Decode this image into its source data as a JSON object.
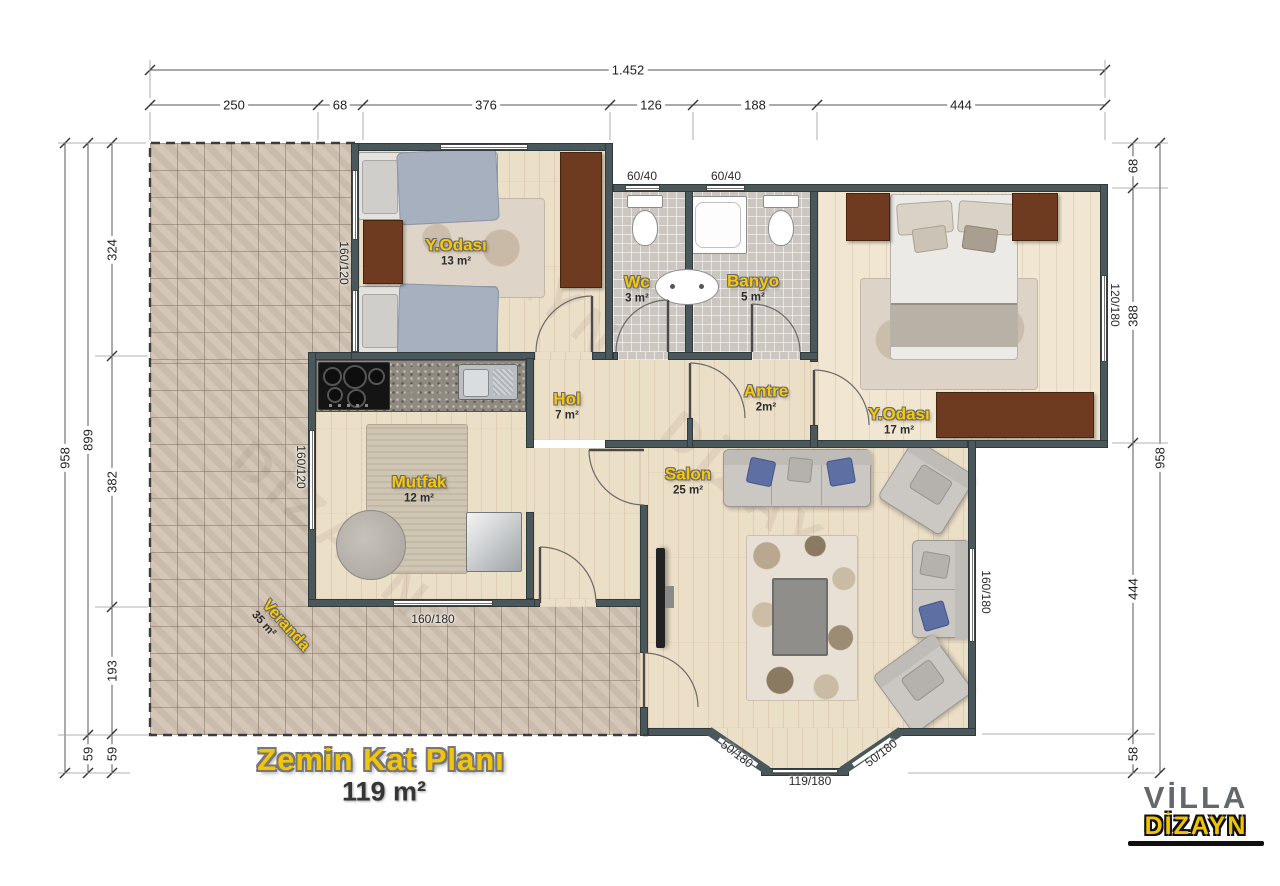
{
  "title": {
    "name": "Zemin Kat Planı",
    "area": "119 m²"
  },
  "logo": {
    "top": "VİLLA",
    "bottom": "DİZAYN"
  },
  "watermark": "DİZAYN",
  "rooms": {
    "bedroom1": {
      "name": "Y.Odası",
      "area": "13 m²"
    },
    "wc": {
      "name": "Wc",
      "area": "3 m²"
    },
    "banyo": {
      "name": "Banyo",
      "area": "5 m²"
    },
    "bedroom2": {
      "name": "Y.Odası",
      "area": "17 m²"
    },
    "hol": {
      "name": "Hol",
      "area": "7 m²"
    },
    "antre": {
      "name": "Antre",
      "area": "2m²"
    },
    "mutfak": {
      "name": "Mutfak",
      "area": "12 m²"
    },
    "salon": {
      "name": "Salon",
      "area": "25 m²"
    },
    "veranda": {
      "name": "Veranda",
      "area": "35 m²"
    }
  },
  "dimensions": {
    "top_total": "1.452",
    "top_segments": [
      "250",
      "68",
      "376",
      "126",
      "188",
      "444"
    ],
    "left_outer": "958",
    "left_middle": [
      "899",
      "59"
    ],
    "left_inner": [
      "324",
      "382",
      "193",
      "59"
    ],
    "right_inner": [
      "68",
      "388",
      "444",
      "58"
    ],
    "right_outer": "958"
  },
  "window_labels": {
    "wc_top": "60/40",
    "banyo_top": "60/40",
    "bedroom1_left": "160/120",
    "mutfak_left": "160/120",
    "mutfak_bottom": "160/180",
    "bedroom2_right": "120/180",
    "salon_right": "160/180",
    "bay_left": "50/180",
    "bay_center": "119/180",
    "bay_right": "50/180"
  },
  "colors": {
    "accent_yellow": "#f2c40a",
    "wall": "#4a575b",
    "wood_floor": "#ecdfc8",
    "veranda_tile": "#d2c4b4",
    "bath_tile": "#cbc6c0",
    "wardrobe_brown": "#6e3b21"
  }
}
